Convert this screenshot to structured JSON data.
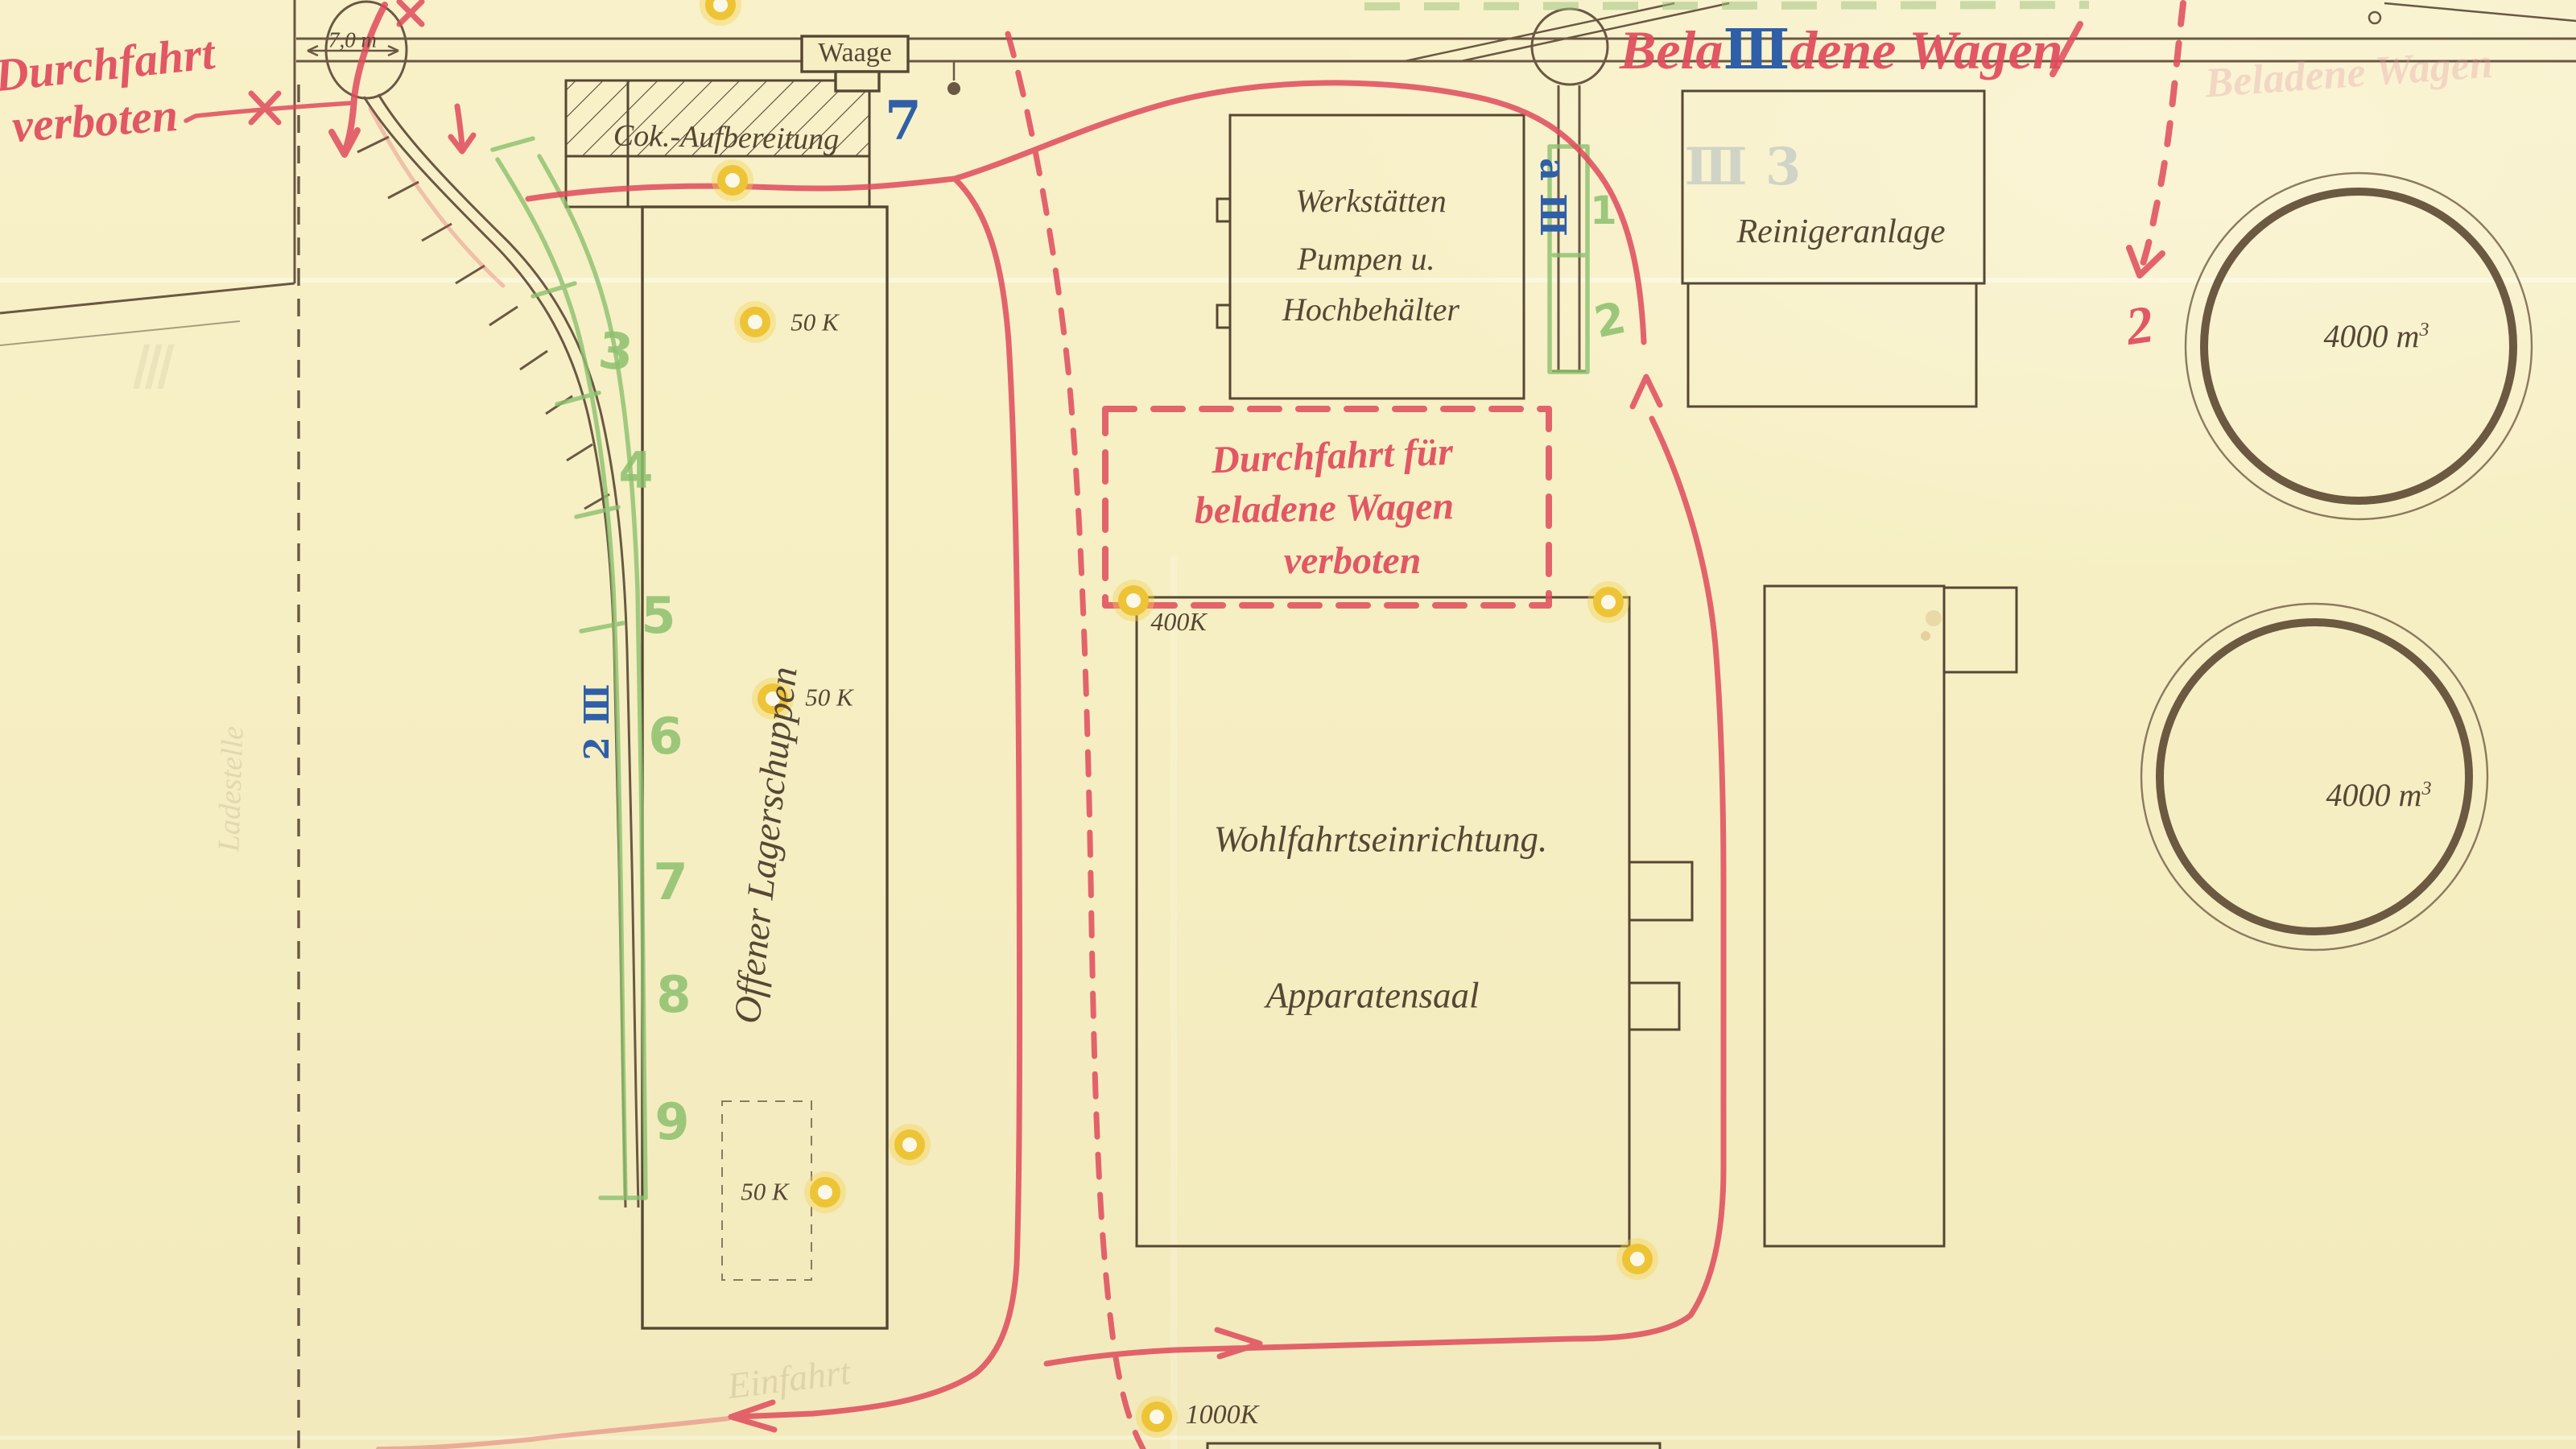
{
  "colors": {
    "paper": "#f6efc3",
    "ink_brown": "#6a5843",
    "crayon_red": "#e04a5c",
    "crayon_green": "#8cc06e",
    "ink_blue": "#2f5fa8",
    "highlight_yellow": "#eec437",
    "pencil": "#b3a283"
  },
  "notes": {
    "durchfahrt_line1": "Durchfahrt",
    "durchfahrt_line2": "verboten",
    "dashed_box_line1": "Durchfahrt für",
    "dashed_box_line2": "beladene Wagen",
    "dashed_box_line3": "verboten",
    "beladene_pre": "Bela",
    "beladene_insert": "Ⅲ",
    "beladene_post": "dene Wagen",
    "red_number_2": "2",
    "ghost_beladene": "Beladene Wagen",
    "pencil_einfahrt": "Einfahrt",
    "pencil_ladestelle": "Ladestelle",
    "pencil_roman_iii": "Ⅲ",
    "ghost_blue_iii3": "Ⅲ 3"
  },
  "buildings": {
    "waage": "Waage",
    "cok_aufbereitung": "Cok.-Aufbereitung",
    "werkstaetten_line1": "Werkstätten",
    "werkstaetten_line2": "Pumpen u.",
    "werkstaetten_line3": "Hochbehälter",
    "reinigeranlage": "Reinigeranlage",
    "wohlfahrt": "Wohlfahrtseinrichtung.",
    "apparatensaal": "Apparatensaal",
    "lagerschuppen": "Offener Lagerschuppen",
    "tank1_volume": "4000 m",
    "tank1_sup": "3",
    "tank2_volume": "4000 m",
    "tank2_sup": "3"
  },
  "track_marks": {
    "dimension": "7,0 m",
    "blue_7": "7",
    "blue_a3": "a Ⅲ",
    "blue_2_3": "2 Ⅲ",
    "green_1": "1",
    "green_2": "2",
    "green_3": "3",
    "green_4": "4",
    "green_5": "5",
    "green_6": "6",
    "green_7": "7",
    "green_8": "8",
    "green_9": "9"
  },
  "capacity_labels": {
    "k50_a": "50 K",
    "k50_b": "50 K",
    "k50_c": "50 K",
    "k400": "400K",
    "k1000": "1000K"
  }
}
